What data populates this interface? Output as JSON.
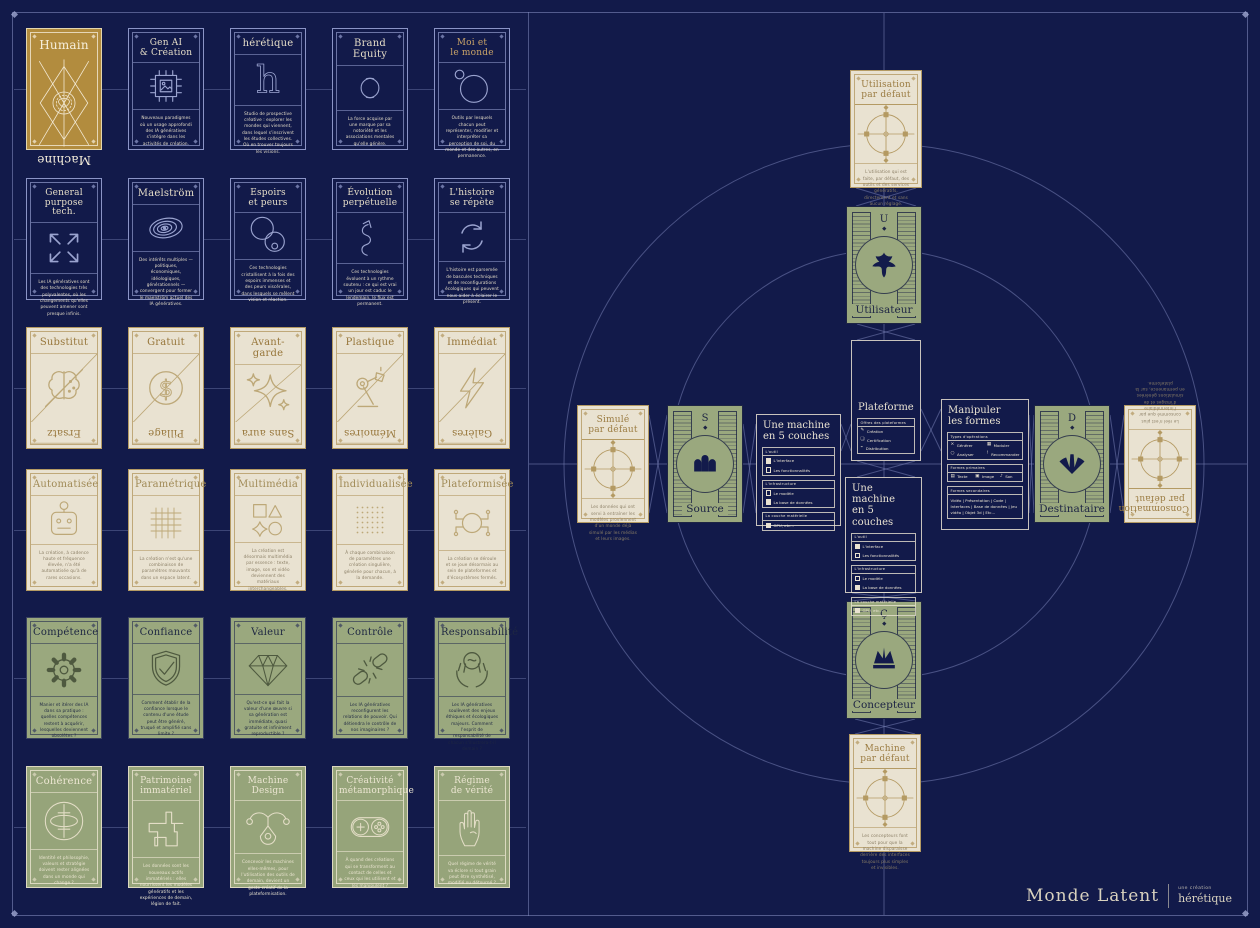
{
  "palette": {
    "background": "#121a4a",
    "navy_line": "#8b94c6",
    "cream": "#e9e2d1",
    "gold": "#b28c3e",
    "green": "#9aa87e",
    "dark_text": "#1d2444",
    "tan_line": "#b49a63"
  },
  "left_grid": {
    "rows": [
      {
        "cards": [
          {
            "id": "humain-machine",
            "variant": "gold",
            "title": [
              "Humain"
            ],
            "flip": "Machine",
            "icon": "sacred-geometry",
            "body": ""
          },
          {
            "id": "gen-ai-creation",
            "variant": "navy",
            "title": [
              "Gen AI",
              "& Création"
            ],
            "icon": "chip-image",
            "body": "Nouveaux paradigmes où un usage approfondi des IA génératives s'intègre dans les activités de création."
          },
          {
            "id": "heretique",
            "variant": "navy",
            "title": [
              "hérétique"
            ],
            "icon": "letter-h",
            "body": "Studio de prospective créative : explorer les mondes qui viennent, dans lequel s'inscrivent les études collectives. Où en trouver toujours les visions."
          },
          {
            "id": "brand-equity",
            "variant": "navy",
            "title": [
              "Brand Equity"
            ],
            "icon": "interlocked-c",
            "body": "La force acquise par une marque par sa notoriété et les associations mentales qu'elle génère."
          },
          {
            "id": "moi-et-le-monde",
            "variant": "navy",
            "title": [
              "Moi et",
              "le monde"
            ],
            "title_gold": true,
            "icon": "planet-moon",
            "body": "Outils par lesquels chacun peut représenter, modifier et interpréter sa perception de soi, du monde et des autres, en permanence."
          }
        ]
      },
      {
        "cards": [
          {
            "id": "general-purpose-tech",
            "variant": "navy",
            "title": [
              "General",
              "purpose tech."
            ],
            "icon": "arrows-out",
            "body": "Les IA génératives sont des technologies très polyvalentes, où les changements qu'elles peuvent amener sont presque infinis."
          },
          {
            "id": "maelstrom",
            "variant": "navy",
            "title": [
              "Maelström"
            ],
            "icon": "vortex",
            "body": "Des intérêts multiples — politiques, économiques, idéologiques, générationnels — convergent pour former le maelström actuel des IA génératives."
          },
          {
            "id": "espoirs-et-peurs",
            "variant": "navy",
            "title": [
              "Espoirs",
              "et peurs"
            ],
            "icon": "circles-pair",
            "body": "Ces technologies cristallisent à la fois des espoirs immenses et des peurs viscérales, dans lesquels se mêlent vision et réaction."
          },
          {
            "id": "evolution-perpetuelle",
            "variant": "navy",
            "title": [
              "Évolution",
              "perpétuelle"
            ],
            "icon": "winding-arrow",
            "body": "Ces technologies évoluent à un rythme soutenu : ce qui est vrai un jour est caduc le lendemain, le flux est permanent."
          },
          {
            "id": "histoire-se-repete",
            "variant": "navy",
            "title": [
              "L'histoire",
              "se répète"
            ],
            "icon": "cycle-arrows",
            "body": "L'histoire est parsemée de bascules techniques et de reconfigurations écologiques qui peuvent nous aider à éclairer le présent."
          }
        ]
      },
      {
        "cards": [
          {
            "id": "substitut-ersatz",
            "variant": "duo",
            "title": [
              "Substitut"
            ],
            "flip": "Ersatz",
            "icon": "split-brain",
            "body": ""
          },
          {
            "id": "gratuit-pillage",
            "variant": "duo",
            "title": [
              "Gratuit"
            ],
            "flip": "Pillage",
            "icon": "dollar-circle",
            "body": ""
          },
          {
            "id": "avant-garde-sans-aura",
            "variant": "duo",
            "title": [
              "Avant-garde"
            ],
            "flip": "Sans aura",
            "icon": "sparkles",
            "body": ""
          },
          {
            "id": "plastique-memoires",
            "variant": "duo",
            "title": [
              "Plastique"
            ],
            "flip": "Mémoires",
            "icon": "robot-arm",
            "body": ""
          },
          {
            "id": "immediat-galeres",
            "variant": "duo",
            "title": [
              "Immédiat"
            ],
            "flip": "Galères",
            "icon": "lightning",
            "body": ""
          }
        ]
      },
      {
        "cards": [
          {
            "id": "automatisee",
            "variant": "cream",
            "title": [
              "Automatisée"
            ],
            "icon": "robot-head",
            "body": "La création, à cadence haute et fréquence élevée, n'a été automatisée qu'à de rares occasions."
          },
          {
            "id": "parametrique",
            "variant": "cream",
            "title": [
              "Paramétrique"
            ],
            "icon": "grid",
            "body": "La création n'est qu'une combinaison de paramètres mouvants dans un espace latent."
          },
          {
            "id": "multimedia",
            "variant": "cream",
            "title": [
              "Multimédia"
            ],
            "icon": "shapes",
            "body": "La création est désormais multimédia par essence : texte, image, son et vidéo deviennent des matériaux interchangeables."
          },
          {
            "id": "individualisee",
            "variant": "cream",
            "title": [
              "Individualisée"
            ],
            "icon": "dot-matrix",
            "body": "À chaque combinaison de paramètres une création singulière, générée pour chacun, à la demande."
          },
          {
            "id": "plateformisee",
            "variant": "cream",
            "title": [
              "Plateformisée"
            ],
            "icon": "hub-network",
            "body": "La création se déroule et se joue désormais au sein de plateformes et d'écosystèmes fermés."
          }
        ]
      },
      {
        "cards": [
          {
            "id": "competence",
            "variant": "green",
            "title": [
              "Compétence"
            ],
            "icon": "gear",
            "body": "Manier et itérer des IA dans sa pratique : quelles compétences restent à acquérir, lesquelles deviennent obsolètes ?"
          },
          {
            "id": "confiance",
            "variant": "green",
            "title": [
              "Confiance"
            ],
            "icon": "shield-check",
            "body": "Comment établir de la confiance lorsque le contenu d'une étude peut être généré, truqué et amplifié sans limite ?"
          },
          {
            "id": "valeur",
            "variant": "green",
            "title": [
              "Valeur"
            ],
            "icon": "diamond",
            "body": "Qu'est-ce qui fait la valeur d'une œuvre si sa génération est immédiate, quasi gratuite et infiniment reproductible ?"
          },
          {
            "id": "controle",
            "variant": "green",
            "title": [
              "Contrôle"
            ],
            "icon": "broken-chain",
            "body": "Les IA génératives reconfigurent les relations de pouvoir. Qui détiendra le contrôle de nos imaginaires ?"
          },
          {
            "id": "responsabilite",
            "variant": "green",
            "title": [
              "Responsabilité"
            ],
            "icon": "hands-globe",
            "body": "Les IA génératives soulèvent des enjeux éthiques et écologiques majeurs. Comment l'esprit de responsabilité de chacun s'illustrera-t-il demain ?"
          }
        ]
      },
      {
        "cards": [
          {
            "id": "coherence",
            "variant": "green2",
            "title": [
              "Cohérence"
            ],
            "icon": "orbit",
            "body": "Identité et philosophie, valeurs et stratégie doivent rester alignées dans un monde qui change ?"
          },
          {
            "id": "patrimoine-immateriel",
            "variant": "green2",
            "title": [
              "Patrimoine",
              "immatériel"
            ],
            "icon": "pixel-star",
            "body": "Les données sont les nouveaux actifs immatériels : elles nourrissent les modèles génératifs et les expériences de demain, légion de fait."
          },
          {
            "id": "machine-design",
            "variant": "green2",
            "title": [
              "Machine",
              "Design"
            ],
            "icon": "pen-tool",
            "body": "Concevoir les machines elles-mêmes, pour l'utilisation des outils de demain, devient un geste créatif de la plateformisation."
          },
          {
            "id": "creativite-metamorphique",
            "variant": "green2",
            "title": [
              "Créativité",
              "métamorphique"
            ],
            "icon": "gamepad",
            "body": "À quand des créations qui se transforment au contact de celles et ceux qui les utilisent et les manipulent ?"
          },
          {
            "id": "regime-de-verite",
            "variant": "green2",
            "title": [
              "Régime",
              "de vérité"
            ],
            "icon": "open-hand",
            "body": "Quel régime de vérité va éclore si tout grain peut être synthétisé, modifié ou détourné ?"
          }
        ]
      }
    ]
  },
  "right": {
    "compass_cards": [
      {
        "id": "utilisation-par-defaut",
        "title": [
          "Utilisation",
          "par défaut"
        ],
        "icon": "compass",
        "body": "L'utilisation qui est faite, par défaut, des outils et des services génératifs, directement et sans aucun réglage."
      },
      {
        "id": "simule-par-defaut",
        "title": [
          "Simulé",
          "par défaut"
        ],
        "icon": "compass",
        "body": "Les données qui ont servi à entraîner les modèles proviennent d'un monde déjà simulé par les médias et leurs images."
      },
      {
        "id": "consommation-par-defaut",
        "title": [
          "Consommation",
          "par défaut"
        ],
        "icon": "compass",
        "rotated": true,
        "body": "Le réel n'est plus consommé que par l'intermédiaire d'images et de simulations générées en permanence, sur la plateforme."
      },
      {
        "id": "machine-par-defaut",
        "title": [
          "Machine",
          "par défaut"
        ],
        "icon": "compass",
        "body": "Les concepteurs font tout pour que la machine disparaisse derrière des interfaces toujours plus simples et invisibles."
      }
    ],
    "actor_cards": [
      {
        "id": "utilisateur",
        "letter": "U",
        "label": "Utilisateur",
        "icon": "matisse-leaf"
      },
      {
        "id": "source",
        "letter": "S",
        "label": "Source",
        "icon": "triple-arches"
      },
      {
        "id": "destinataire",
        "letter": "D",
        "label": "Destinataire",
        "icon": "fan-burst"
      },
      {
        "id": "concepteur",
        "letter": "Ç",
        "label": "Concepteur",
        "icon": "crown"
      }
    ],
    "boxes": {
      "plateforme": {
        "title": [
          "Plateforme"
        ],
        "panel": {
          "header": "Offres des plateformes",
          "items": [
            {
              "glyph": "✎",
              "label": "Création"
            },
            {
              "glyph": "❏",
              "label": "Certification"
            },
            {
              "glyph": "⌁",
              "label": "Distribution"
            }
          ]
        }
      },
      "machine5": {
        "title": [
          "Une machine",
          "en 5 couches"
        ],
        "panels": [
          {
            "header": "L'outil",
            "items": [
              {
                "filled": true,
                "label": "L'interface"
              },
              {
                "filled": false,
                "label": "Les fonctionnalités"
              }
            ]
          },
          {
            "header": "L'infrastructure",
            "items": [
              {
                "filled": false,
                "label": "Le modèle"
              },
              {
                "filled": true,
                "label": "La base de données"
              }
            ]
          },
          {
            "header": "La couche matérielle",
            "items": [
              {
                "filled": true,
                "label": "GPU, etc..."
              }
            ]
          }
        ]
      },
      "manipuler": {
        "title": [
          "Manipuler",
          "les formes"
        ],
        "panels": [
          {
            "header": "Types d'opérations",
            "grid": [
              {
                "glyph": "×",
                "label": "Générer"
              },
              {
                "glyph": "▦",
                "label": "Moduler"
              },
              {
                "glyph": "○",
                "label": "Analyser"
              },
              {
                "glyph": "!",
                "label": "Recommander"
              }
            ]
          },
          {
            "header": "Formes primaires",
            "grid3": [
              {
                "glyph": "▤",
                "label": "Texte"
              },
              {
                "glyph": "▣",
                "label": "Image"
              },
              {
                "glyph": "♪",
                "label": "Son"
              }
            ]
          },
          {
            "header": "Formes secondaires",
            "text": "Vidéo | Présentation | Code | Interfaces | Base de données | Jeu vidéo | Objet 3d | Etc..."
          }
        ]
      }
    },
    "logo": {
      "title": "Monde Latent",
      "sub_top": "une création",
      "sub_bottom": "hérétique"
    }
  }
}
